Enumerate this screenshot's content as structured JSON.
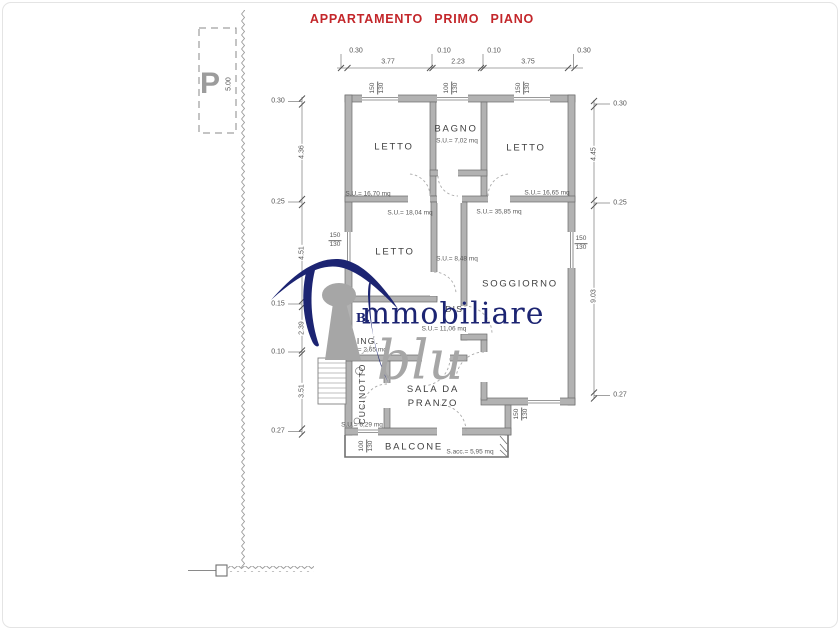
{
  "title": "APPARTAMENTO PRIMO PIANO",
  "parking": {
    "symbol": "P",
    "depth": "5.00"
  },
  "rooms": {
    "letto_nw": {
      "label": "LETTO",
      "area": "S.U.= 16,70 mq"
    },
    "bagno": {
      "label": "BAGNO",
      "area": "S.U.= 7,02 mq"
    },
    "letto_ne": {
      "label": "LETTO",
      "area": "S.U.= 16,65 mq"
    },
    "letto_w": {
      "label": "LETTO",
      "area": "S.U.= 18,04 mq"
    },
    "corridoio": {
      "area": "S.U.= 8,48 mq"
    },
    "soggiorno": {
      "label": "SOGGIORNO",
      "area": "S.U.= 35,85 mq"
    },
    "disimpegno": {
      "label": "DIS.",
      "area": "S.U.= 11,06 mq"
    },
    "ingresso": {
      "label": "ING.",
      "area": "S.U.= 2,65 mq"
    },
    "cucinotto": {
      "label": "CUCINOTTO",
      "area": "S.U.= 6,29 mq"
    },
    "sala_da_pranzo": {
      "label": "SALA DA PRANZO"
    },
    "balcone": {
      "label": "BALCONE",
      "area": "S.acc.= 5,95 mq"
    }
  },
  "dimensions": {
    "top": {
      "d1": "0.30",
      "d2": "3.77",
      "d3": "0.10",
      "d4": "2.23",
      "d5": "0.10",
      "d6": "3.75",
      "d7": "0.30"
    },
    "left": {
      "d1": "0.30",
      "d2": "4.36",
      "d3": "0.25",
      "d4": "4.51",
      "d5": "0.15",
      "d6": "2.39",
      "d7": "0.10",
      "d8": "3.51",
      "d9": "0.27"
    },
    "right": {
      "d1": "0.30",
      "d2": "4.45",
      "d3": "0.25",
      "d4": "9.03",
      "d5": "0.27"
    }
  },
  "windows": {
    "top_left": {
      "w": "150",
      "h": "130"
    },
    "top_mid": {
      "w": "100",
      "h": "130"
    },
    "top_right": {
      "w": "150",
      "h": "130"
    },
    "left": {
      "w": "150",
      "h": "130"
    },
    "right": {
      "w": "150",
      "h": "130"
    },
    "bottom_right": {
      "w": "150",
      "h": "130"
    },
    "balcony": {
      "w": "100",
      "h": "130"
    }
  },
  "watermark": {
    "initial": "B.",
    "brand": "mmobiliare",
    "script": "blu"
  },
  "colors": {
    "title_red": "#c3262a",
    "wall_gray": "#b2b2b2",
    "navy": "#1c2472",
    "gray": "#a6a6a6"
  }
}
